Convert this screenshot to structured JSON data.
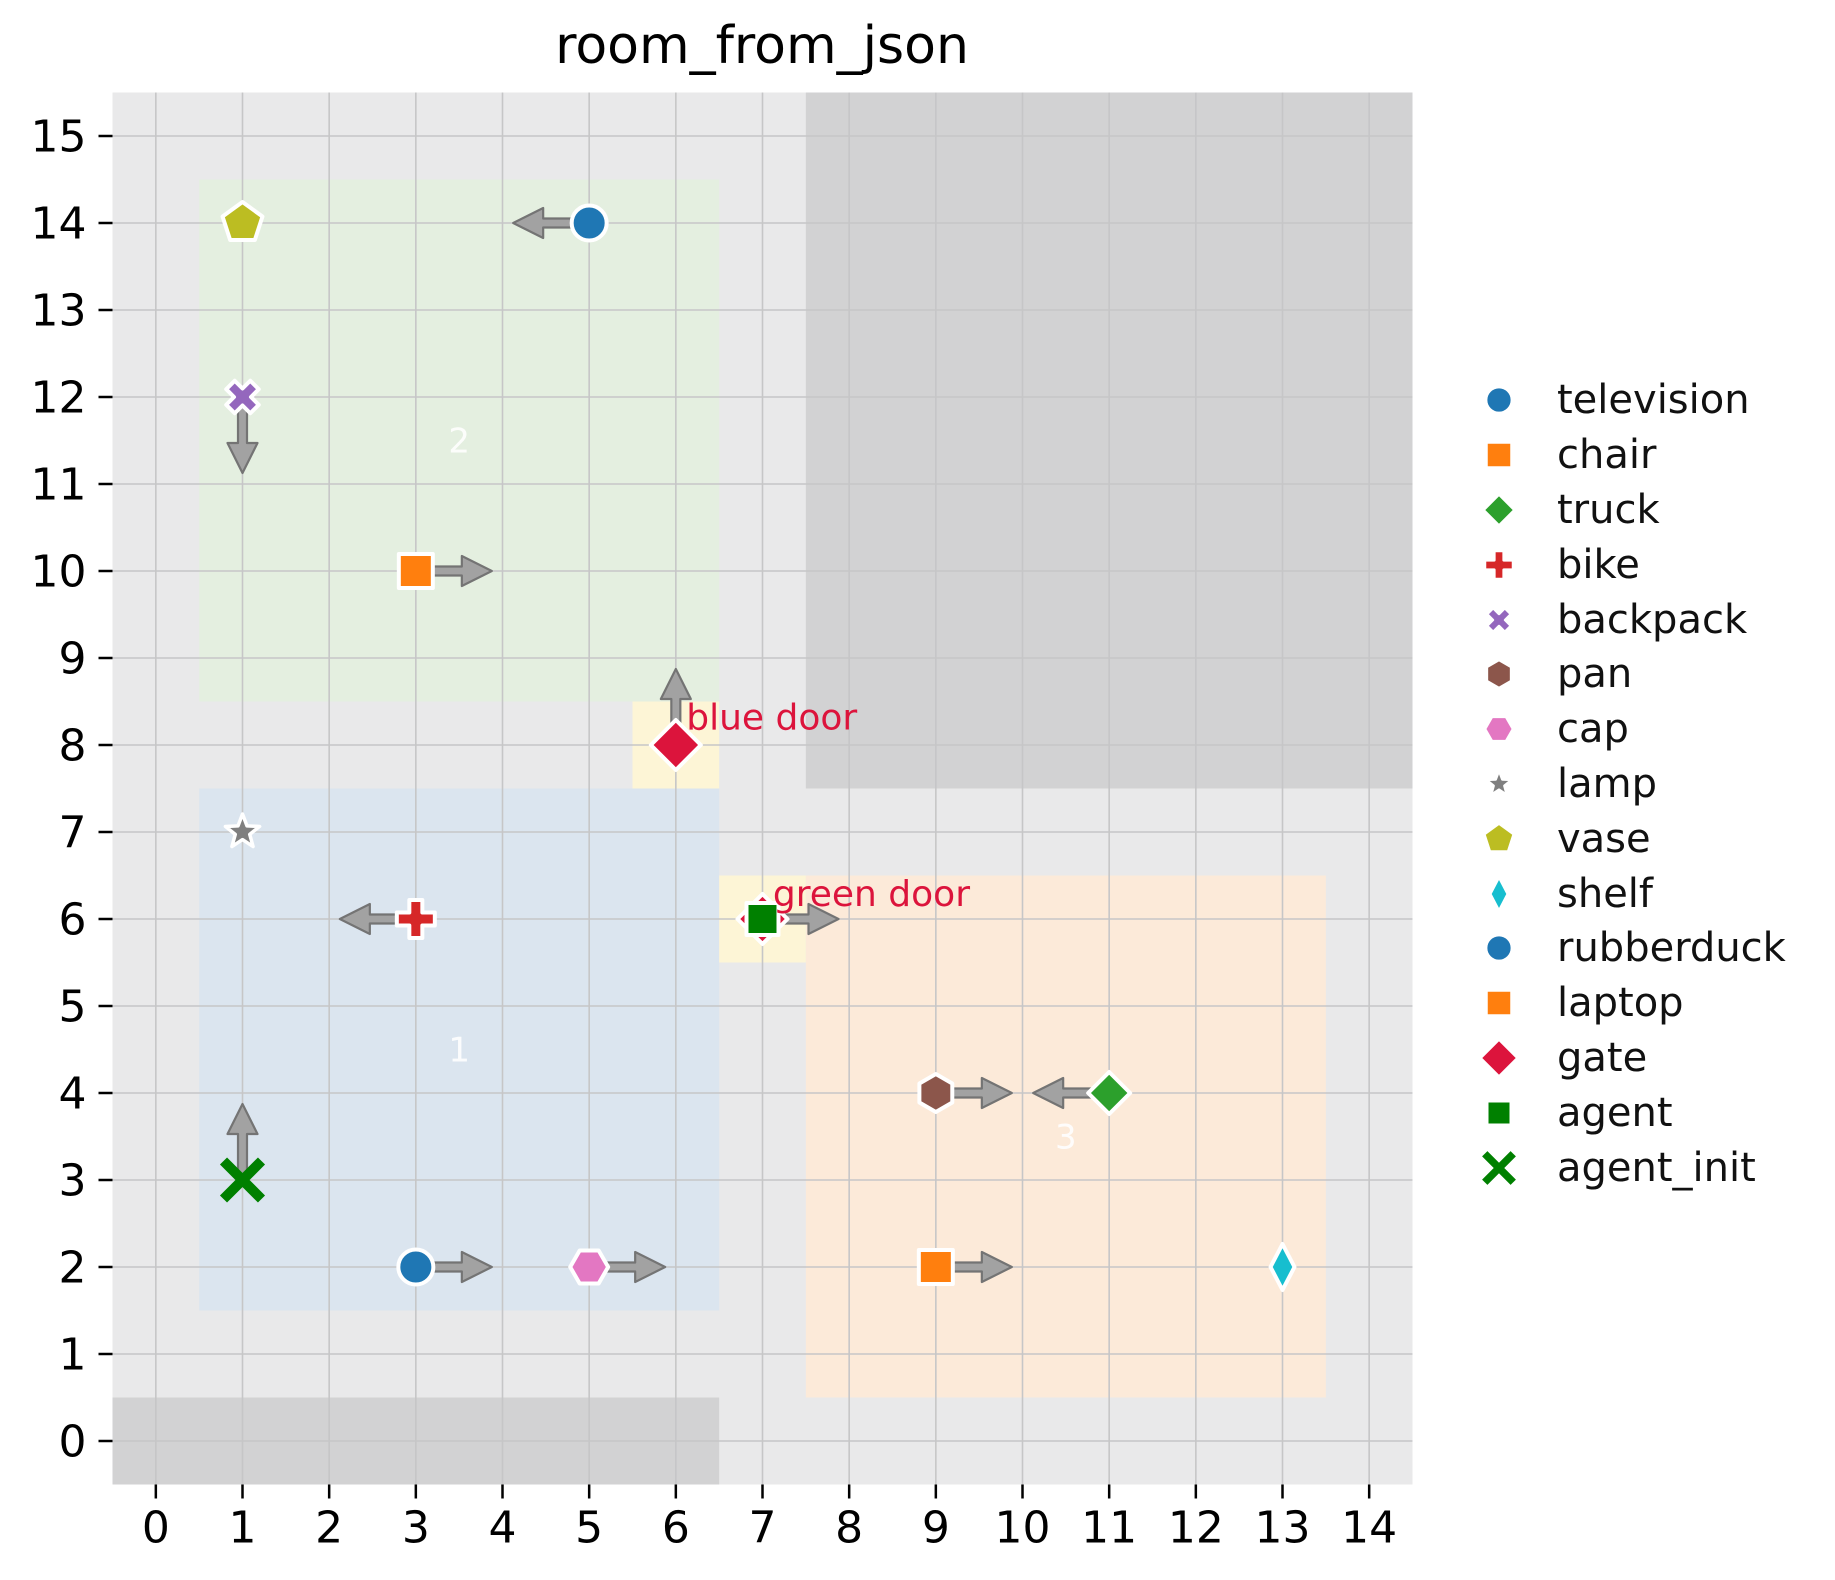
{
  "chart_data": {
    "type": "scatter",
    "title": "room_from_json",
    "xlim": [
      -0.5,
      14.5
    ],
    "ylim": [
      -0.5,
      15.5
    ],
    "grid": true,
    "xticks": [
      0,
      1,
      2,
      3,
      4,
      5,
      6,
      7,
      8,
      9,
      10,
      11,
      12,
      13,
      14
    ],
    "yticks": [
      0,
      1,
      2,
      3,
      4,
      5,
      6,
      7,
      8,
      9,
      10,
      11,
      12,
      13,
      14,
      15
    ],
    "colors": {
      "plot_background": "#e9e9ea",
      "blocked_area": "#d2d2d3",
      "grid_line": "#c6c6c7",
      "door_cell": "#fdf5d6",
      "door_label": "#dc143c",
      "room_label": "#ffffff",
      "arrow_fill": "#a2a2a2",
      "arrow_edge": "#747474",
      "tick_label": "#000000"
    },
    "blocked_areas": [
      {
        "name": "blocked-bottom-left",
        "x0": -0.5,
        "y0": -0.5,
        "x1": 6.5,
        "y1": 0.5
      },
      {
        "name": "blocked-top-right",
        "x0": 7.5,
        "y0": 7.5,
        "x1": 14.5,
        "y1": 15.5
      }
    ],
    "rooms": [
      {
        "id": "1",
        "color": "#dbe5ef",
        "x0": 0.5,
        "y0": 1.5,
        "x1": 6.5,
        "y1": 7.5,
        "label": "1",
        "label_x": 3.5,
        "label_y": 4.5
      },
      {
        "id": "2",
        "color": "#e4efe0",
        "x0": 0.5,
        "y0": 8.5,
        "x1": 6.5,
        "y1": 14.5,
        "label": "2",
        "label_x": 3.5,
        "label_y": 11.5
      },
      {
        "id": "3",
        "color": "#fcead9",
        "x0": 7.5,
        "y0": 0.5,
        "x1": 13.5,
        "y1": 6.5,
        "label": "3",
        "label_x": 10.5,
        "label_y": 3.5
      }
    ],
    "door_cells": [
      {
        "name": "blue-door-cell",
        "x0": 5.5,
        "y0": 7.5,
        "x1": 6.5,
        "y1": 8.5
      },
      {
        "name": "green-door-cell",
        "x0": 6.5,
        "y0": 5.5,
        "x1": 7.5,
        "y1": 6.5
      }
    ],
    "door_labels": [
      {
        "text": "blue door",
        "x": 6.12,
        "y": 8.18
      },
      {
        "text": "green door",
        "x": 7.12,
        "y": 6.15
      }
    ],
    "objects": [
      {
        "name": "television",
        "marker": "circle",
        "color": "#1f77b4",
        "x": 5,
        "y": 14,
        "arrow": "left"
      },
      {
        "name": "vase",
        "marker": "pentagon",
        "color": "#bcbd22",
        "x": 1,
        "y": 14,
        "arrow": null
      },
      {
        "name": "backpack",
        "marker": "x",
        "color": "#9467bd",
        "x": 1,
        "y": 12,
        "arrow": "down"
      },
      {
        "name": "chair",
        "marker": "square",
        "color": "#ff7f0e",
        "x": 3,
        "y": 10,
        "arrow": "right"
      },
      {
        "name": "gate",
        "marker": "diamond-big",
        "color": "#dc143c",
        "x": 6,
        "y": 8,
        "arrow": "up"
      },
      {
        "name": "lamp",
        "marker": "star",
        "color": "#7f7f7f",
        "x": 1,
        "y": 7,
        "arrow": null
      },
      {
        "name": "bike",
        "marker": "plus",
        "color": "#d62728",
        "x": 3,
        "y": 6,
        "arrow": "left"
      },
      {
        "name": "gate2",
        "marker": "diamond-big",
        "color": "#dc143c",
        "x": 7,
        "y": 6,
        "arrow": null
      },
      {
        "name": "agent_init",
        "marker": "x-thin",
        "color": "#008000",
        "x": 1,
        "y": 3,
        "arrow": "up"
      },
      {
        "name": "rubberduck",
        "marker": "circle",
        "color": "#1f77b4",
        "x": 3,
        "y": 2,
        "arrow": "right"
      },
      {
        "name": "cap",
        "marker": "hexagon-side",
        "color": "#e377c2",
        "x": 5,
        "y": 2,
        "arrow": "right"
      },
      {
        "name": "pan",
        "marker": "hexagon-top",
        "color": "#8c564b",
        "x": 9,
        "y": 4,
        "arrow": "right"
      },
      {
        "name": "truck",
        "marker": "diamond",
        "color": "#2ca02c",
        "x": 11,
        "y": 4,
        "arrow": "left"
      },
      {
        "name": "laptop",
        "marker": "square",
        "color": "#ff7f0e",
        "x": 9,
        "y": 2,
        "arrow": "right"
      },
      {
        "name": "shelf",
        "marker": "thin-diamond",
        "color": "#17becf",
        "x": 13,
        "y": 2,
        "arrow": null
      },
      {
        "name": "agent",
        "marker": "agent-square",
        "color": "#008000",
        "x": 7,
        "y": 6,
        "arrow": "right"
      }
    ],
    "legend": [
      {
        "label": "television",
        "marker": "circle",
        "color": "#1f77b4"
      },
      {
        "label": "chair",
        "marker": "square",
        "color": "#ff7f0e"
      },
      {
        "label": "truck",
        "marker": "diamond",
        "color": "#2ca02c"
      },
      {
        "label": "bike",
        "marker": "plus",
        "color": "#d62728"
      },
      {
        "label": "backpack",
        "marker": "x",
        "color": "#9467bd"
      },
      {
        "label": "pan",
        "marker": "hexagon-top",
        "color": "#8c564b"
      },
      {
        "label": "cap",
        "marker": "hexagon-side",
        "color": "#e377c2"
      },
      {
        "label": "lamp",
        "marker": "star",
        "color": "#7f7f7f"
      },
      {
        "label": "vase",
        "marker": "pentagon",
        "color": "#bcbd22"
      },
      {
        "label": "shelf",
        "marker": "thin-diamond",
        "color": "#17becf"
      },
      {
        "label": "rubberduck",
        "marker": "circle",
        "color": "#1f77b4"
      },
      {
        "label": "laptop",
        "marker": "square",
        "color": "#ff7f0e"
      },
      {
        "label": "gate",
        "marker": "diamond-big",
        "color": "#dc143c"
      },
      {
        "label": "agent",
        "marker": "agent-square",
        "color": "#008000"
      },
      {
        "label": "agent_init",
        "marker": "x-thin",
        "color": "#008000"
      }
    ]
  }
}
